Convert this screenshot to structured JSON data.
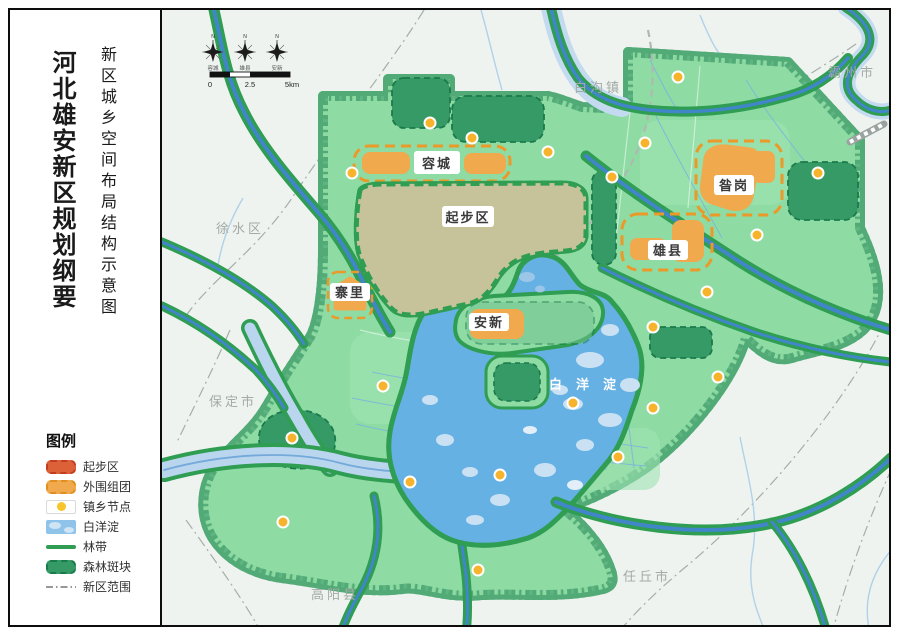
{
  "sidebar": {
    "main_title": "河北雄安新区规划纲要",
    "subtitle": "新区城乡空间布局结构示意图",
    "legend": {
      "title": "图例",
      "items": [
        {
          "label": "起步区"
        },
        {
          "label": "外围组团"
        },
        {
          "label": "镇乡节点"
        },
        {
          "label": "白洋淀"
        },
        {
          "label": "林带"
        },
        {
          "label": "森林斑块"
        },
        {
          "label": "新区范围"
        }
      ]
    }
  },
  "map": {
    "compass": {
      "north_label": "N",
      "stations": [
        "容城",
        "雄县",
        "安新"
      ]
    },
    "scale_bar": {
      "ticks": [
        "0",
        "2.5",
        "5km"
      ]
    },
    "area_labels": {
      "rongcheng": "容城",
      "qibu": "起步区",
      "zangang": "昝岗",
      "xiongxian": "雄县",
      "zhaili": "寨里",
      "anxin": "安新",
      "lake": "白洋淀"
    },
    "place_labels": [
      {
        "text": "霸州市"
      },
      {
        "text": "白沟镇"
      },
      {
        "text": "徐水区"
      },
      {
        "text": "保定市"
      },
      {
        "text": "高阳县"
      },
      {
        "text": "任丘市"
      }
    ],
    "colors": {
      "start_area": "#dc6038",
      "start_area_border": "#d84a28",
      "start_area_ground": "#c6c299",
      "outer_cluster": "#f0a94c",
      "outer_cluster_border": "#eb9929",
      "town_node": "#f7b32b",
      "lake": "#66b1e3",
      "lake_island": "#c9e1f3",
      "forest_belt": "#2f9d52",
      "river_core": "#4086c9",
      "forest_patch": "#369a67",
      "land": "#8edba4",
      "land_band": "#52ab77",
      "wide_river": "#b9d6ee",
      "outside": "#eef3f0",
      "boundary": "#98a29b"
    }
  }
}
